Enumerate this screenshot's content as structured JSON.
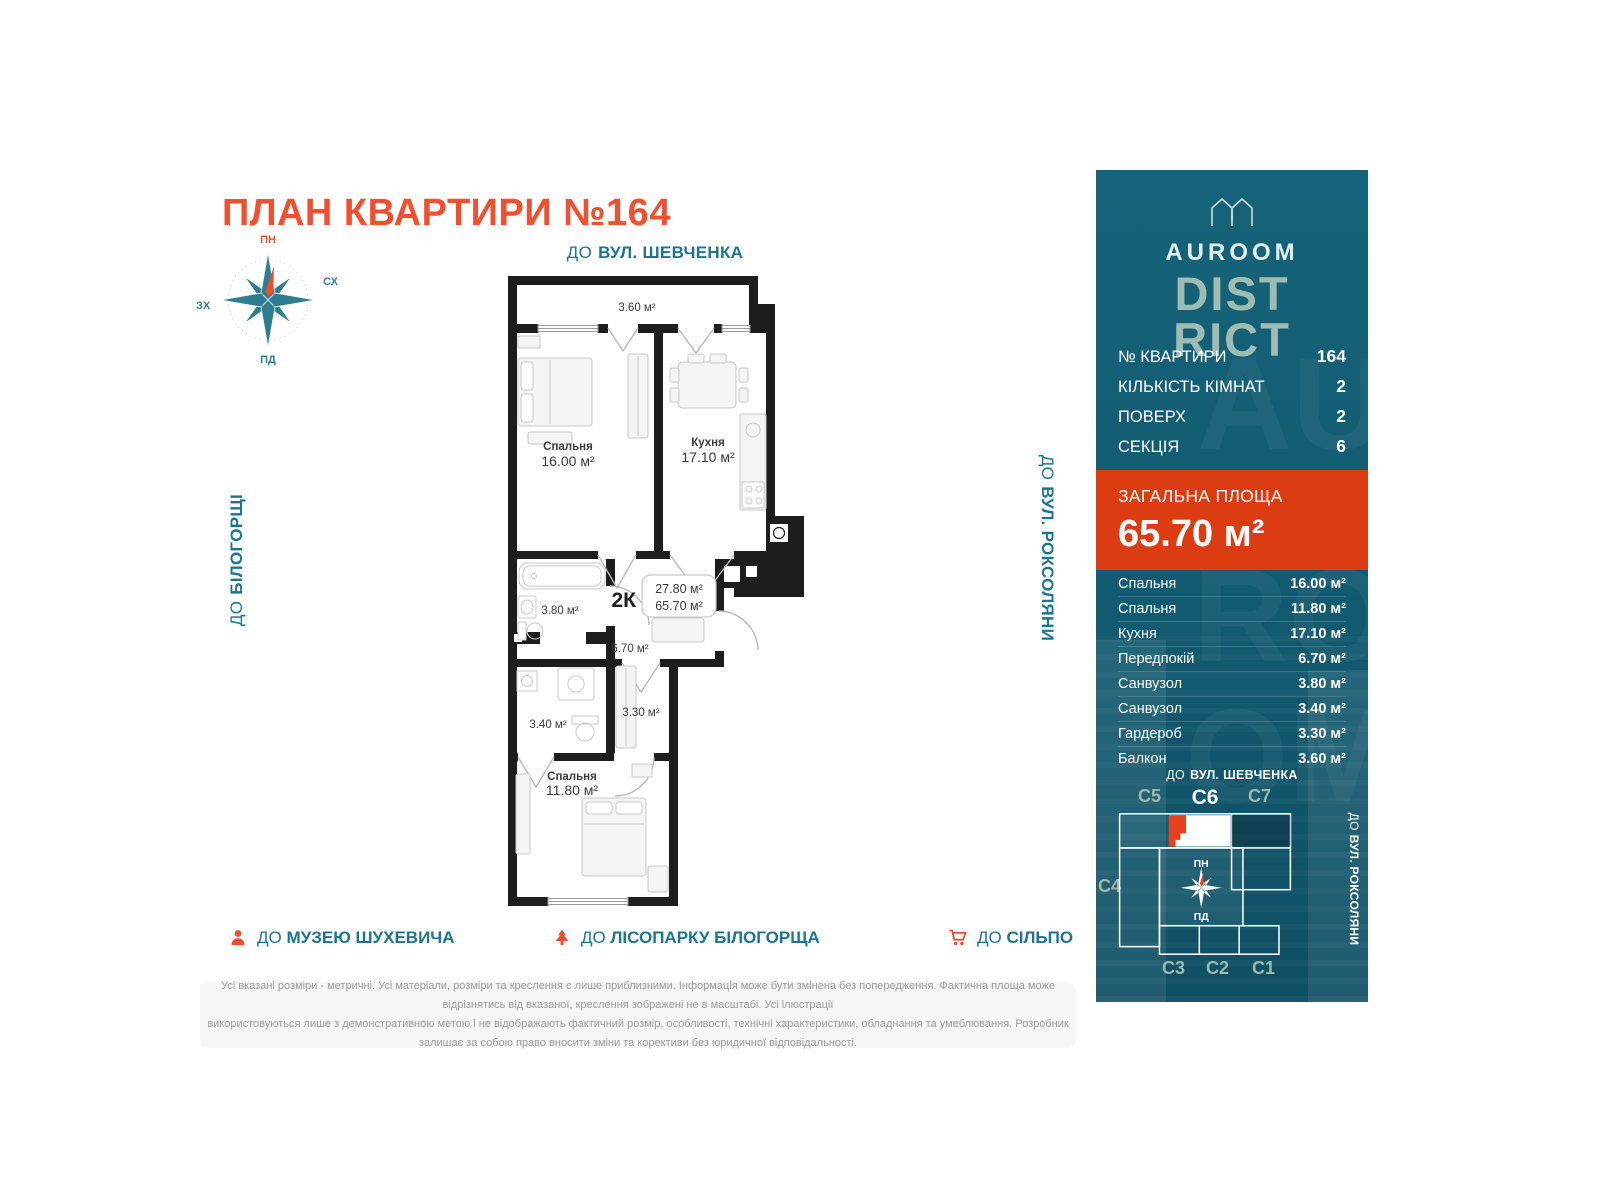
{
  "title": "ПЛАН КВАРТИРИ №164",
  "compass": {
    "north": "ПН",
    "east": "СХ",
    "west": "ЗХ",
    "south": "ПД"
  },
  "directions": {
    "top_prefix": "ДО",
    "top_name": "ВУЛ. ШЕВЧЕНКА",
    "left_prefix": "ДО",
    "left_name": "БІЛОГОРЩІ",
    "right_prefix": "ДО",
    "right_name": "ВУЛ. РОКСОЛЯНИ"
  },
  "plan": {
    "balcony_area": "3.60 м²",
    "bedroom1": {
      "name": "Спальня",
      "area": "16.00 м²"
    },
    "kitchen": {
      "name": "Кухня",
      "area": "17.10 м²"
    },
    "bath1_area": "3.80 м²",
    "hall_area": "6.70 м²",
    "badge": {
      "type": "2К",
      "living_area": "27.80 м²",
      "total_area": "65.70 м²"
    },
    "wardrobe_area": "3.30 м²",
    "bath2_area": "3.40 м²",
    "bedroom2": {
      "name": "Спальня",
      "area": "11.80 м²"
    }
  },
  "poi": {
    "museum": {
      "prefix": "ДО",
      "label": "МУЗЕЮ ШУХЕВИЧА"
    },
    "park": {
      "prefix": "ДО",
      "label": "ЛІСОПАРКУ БІЛОГОРЩА"
    },
    "store": {
      "prefix": "ДО",
      "label": "СІЛЬПО"
    }
  },
  "disclaimer_line1": "Усі вказані розміри - метричні. Усі матеріали, розміри та креслення є лише приблизними. Інформація може бути змінена без попередження. Фактична площа може відрізнятись від вказаної, креслення зображені не в масштабі. Усі ілюстрації",
  "disclaimer_line2": "використовуються лише з демонстративною метою і не відображають фактичний розмір, особливості, технічні характеристики, обладнання та умеблювання. Розробник залишає за собою право вносити зміни та корективи без юридичної відповідальності.",
  "sidebar": {
    "brand": {
      "name": "AUROOM",
      "district1": "DIST",
      "district2": "RICT"
    },
    "info": [
      {
        "label": "№ КВАРТИРИ",
        "value": "164"
      },
      {
        "label": "КІЛЬКІСТЬ КІМНАТ",
        "value": "2"
      },
      {
        "label": "ПОВЕРХ",
        "value": "2"
      },
      {
        "label": "СЕКЦІЯ",
        "value": "6"
      }
    ],
    "total": {
      "label": "ЗАГАЛЬНА ПЛОЩА",
      "value": "65.70 м²"
    },
    "rooms": [
      {
        "name": "Спальня",
        "area": "16.00 м²"
      },
      {
        "name": "Спальня",
        "area": "11.80 м²"
      },
      {
        "name": "Кухня",
        "area": "17.10 м²"
      },
      {
        "name": "Передпокій",
        "area": "6.70 м²"
      },
      {
        "name": "Санвузол",
        "area": "3.80 м²"
      },
      {
        "name": "Санвузол",
        "area": "3.40 м²"
      },
      {
        "name": "Гардероб",
        "area": "3.30 м²"
      },
      {
        "name": "Балкон",
        "area": "3.60 м²"
      }
    ],
    "map": {
      "street_top_prefix": "ДО",
      "street_top_name": "ВУЛ. ШЕВЧЕНКА",
      "street_right_prefix": "ДО",
      "street_right_name": "ВУЛ. РОКСОЛЯНИ",
      "s5": "С5",
      "s6": "С6",
      "s7": "С7",
      "s4": "С4",
      "s3": "С3",
      "s2": "С2",
      "s1": "С1",
      "compass_north": "ПН",
      "compass_south": "ПД"
    }
  },
  "colors": {
    "accent_orange": "#E8502E",
    "total_block_orange": "#DC3C12",
    "title_orange": "#F0502F",
    "teal_text": "#1B7590",
    "sidebar_teal": "#135C72",
    "logo_sage": "#9FBCB2",
    "wall_black": "#1D1D1D"
  }
}
